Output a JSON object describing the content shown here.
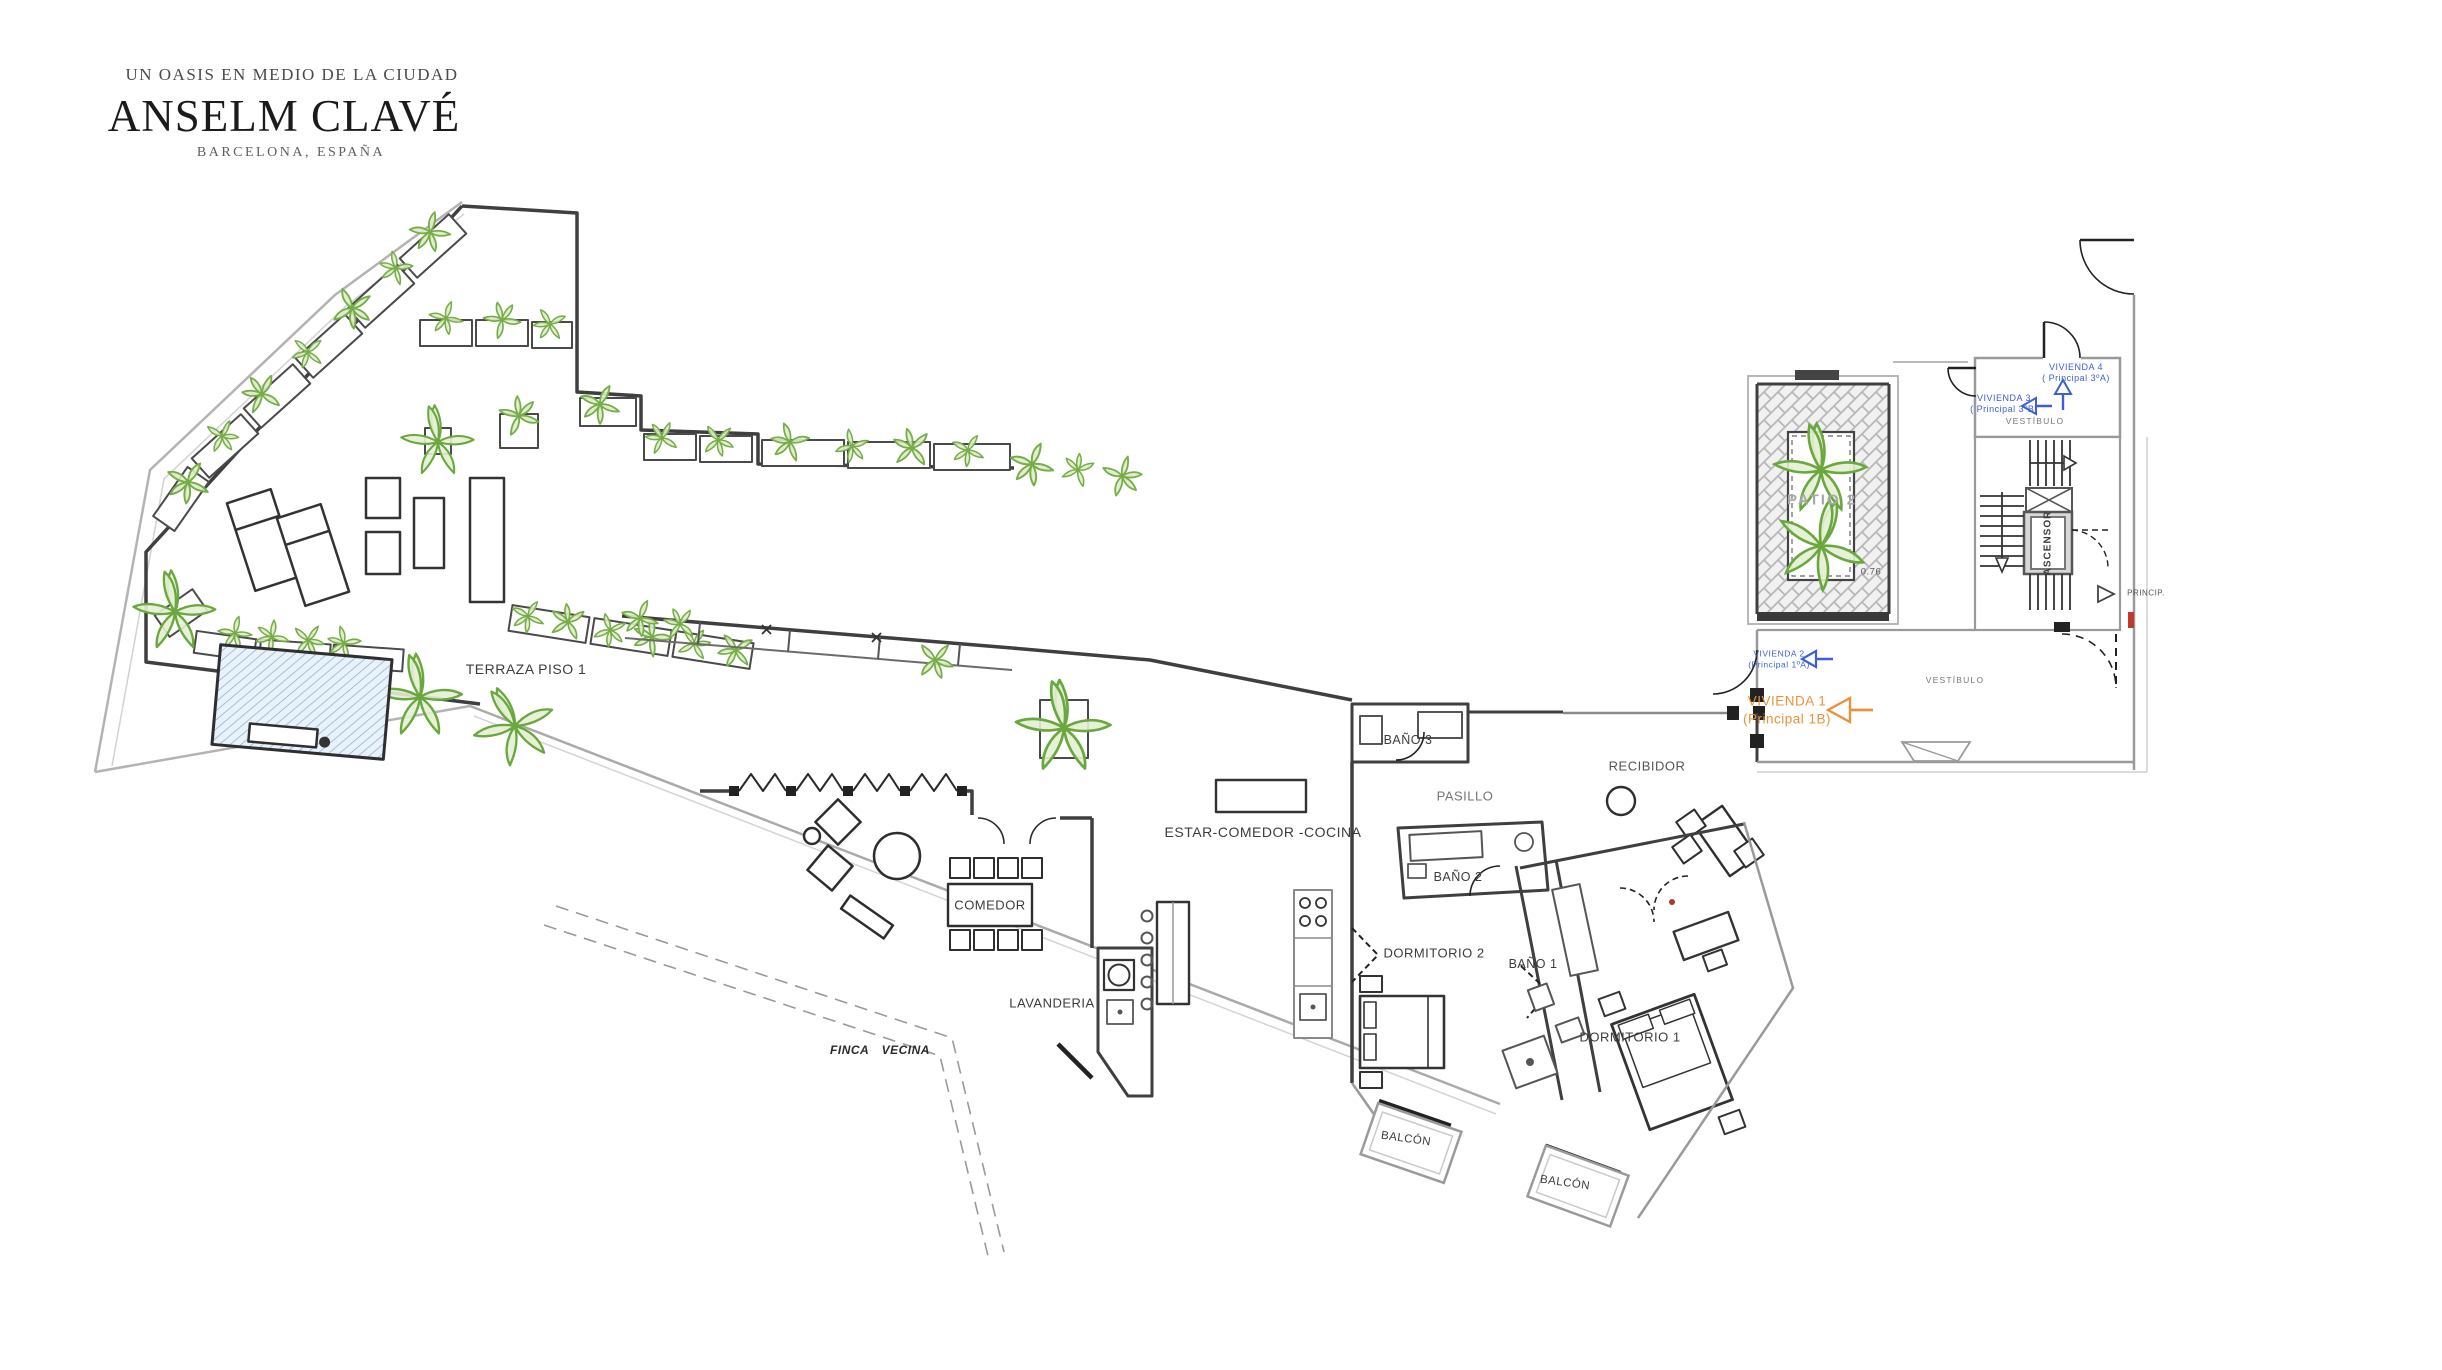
{
  "header": {
    "tagline": "UN OASIS EN MEDIO DE LA CIUDAD",
    "title": "ANSELM CLAVÉ",
    "subtitle": "BARCELONA, ESPAÑA"
  },
  "plan": {
    "rooms": {
      "terraza": "TERRAZA PISO 1",
      "comedor": "COMEDOR",
      "estar_comedor_cocina": "ESTAR-COMEDOR -COCINA",
      "lavanderia": "LAVANDERIA",
      "bano3": "BAÑO 3",
      "pasillo": "PASILLO",
      "recibidor": "RECIBIDOR",
      "bano2": "BAÑO 2",
      "dormitorio2": "DORMITORIO 2",
      "bano1": "BAÑO 1",
      "dormitorio1": "DORMITORIO 1",
      "balcon1": "BALCÓN",
      "balcon2": "BALCÓN",
      "finca_vecina": "FINCA VECINA",
      "patio2": "PATIO 2",
      "vestibulo_upper": "VESTÍBULO",
      "vestibulo_lower": "VESTÍBULO",
      "ascensor": "ASCENSOR"
    },
    "annotations": {
      "vivienda4_line1": "VIVIENDA 4",
      "vivienda4_line2": "( Principal 3ºA)",
      "vivienda3_line1": "VIVIENDA 3",
      "vivienda3_line2": "( Principal 3ºB)",
      "vivienda2_line1": "VIVIENDA 2",
      "vivienda2_line2": "(Principal 1ºA)",
      "vivienda1_line1": "VIVIENDA 1",
      "vivienda1_line2": "(Principal 1B)",
      "princip": "PRINCIP.",
      "dim_076": "0.76"
    }
  },
  "colors": {
    "accent_blue": "#3d5fd3",
    "accent_orange": "#e8933a",
    "plant_green": "#76ad49",
    "pool_blue": "#8fb3d6",
    "wall_dark": "#3f3f3f",
    "boundary_gray": "#9a9a9a",
    "red_accent": "#c0392b"
  }
}
